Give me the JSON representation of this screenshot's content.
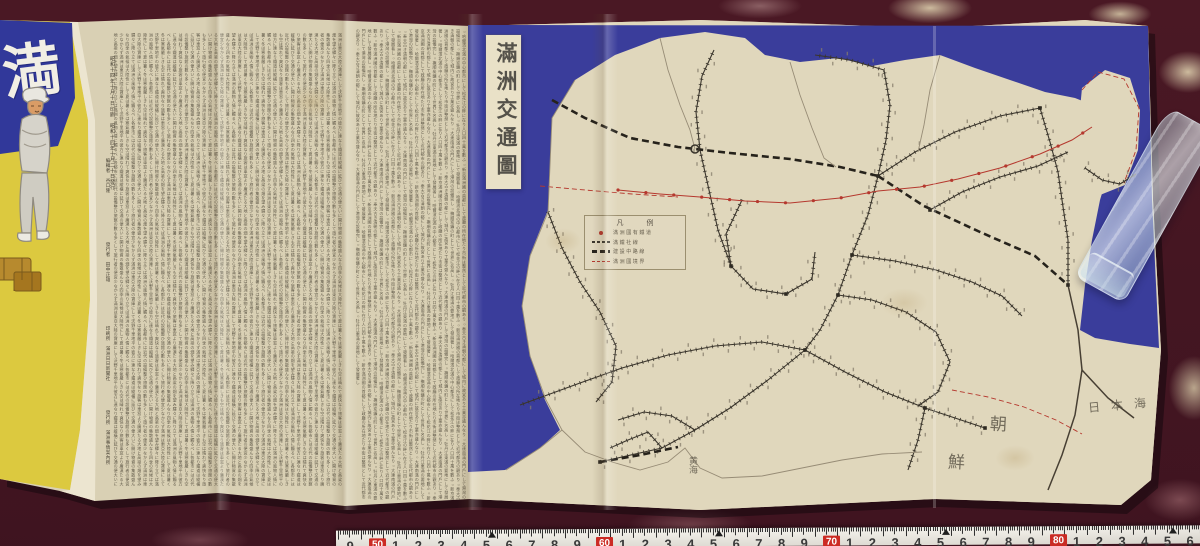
{
  "scene": {
    "carpet_color": "#46172270",
    "paper_color": "#d9d0b4",
    "map_paper_color": "#e0d7bc",
    "sea_color": "#3a3d9b",
    "cover_yellow": "#dcc93f",
    "cover_blue": "#31389a",
    "ink_color": "#4f483a",
    "red_line_color": "#b5382e",
    "rail_color": "#3a352c"
  },
  "cover": {
    "character": "満"
  },
  "colophon": {
    "date_lines": [
      "昭和十四年十月十日印刷",
      "昭和十四年十月二十日發行"
    ],
    "roles": [
      "編輯者　谷口隆",
      "發行者　田中正雄",
      "印刷所　滿洲日日新聞社",
      "發行所　滿洲事情案內所"
    ]
  },
  "text_blocks": {
    "block_a_filler": "滿洲は東亞大陸の寶庫にして沃野千里地平の彼方に連なり鐵道は縱橫に延びて交通の便大いに開け物資の集散盛んなり四季の氣候は大陸性にして夏は暑く冬は寒氣嚴しきも空は晴れて爽快なり旅客は車窓より廣漠たる大地と高粱の畑を望み驛々に降り立てば滿洲の風物人情に觸るべし各都市には近代の設備整ひ旅館の數も多くして旅行者の便宜少なからず",
    "block_b_filler": "○哈爾濱北滿の中心都市にして松花江の畔に在り人口四十萬を數ふ○新京滿洲國の首都にして政廳の所在地たり市街は整然として近代都市の觀あり○奉天古き清朝の都にして城内に故宮あり工業亦盛んなり○大連南滿の門戶にして港灣の設備完し○撫順炭鑛の町として世界に名高し○牡丹江東滿の要地にして發展著し"
  },
  "map": {
    "title": "滿洲交通圖",
    "legend": {
      "title": "凡　例",
      "rows": [
        {
          "sym": "dot",
          "label": "滿洲國有鐵道"
        },
        {
          "sym": "rail",
          "label": "滿鐵社線"
        },
        {
          "sym": "thick",
          "label": "建設中路線"
        },
        {
          "sym": "reddash",
          "label": "滿洲國境界"
        }
      ]
    },
    "sea_labels": [
      {
        "text": "朝",
        "x": 990,
        "y": 410,
        "size": 17,
        "rot": 3
      },
      {
        "text": "鮮",
        "x": 948,
        "y": 448,
        "size": 17,
        "rot": 3
      },
      {
        "text": "日本海",
        "x": 1088,
        "y": 396,
        "size": 12,
        "ls": 11,
        "rot": -5
      },
      {
        "text": "黄海",
        "x": 686,
        "y": 456,
        "size": 9,
        "vertical": true
      }
    ],
    "railways": {
      "ladder": [
        [
          [
            878,
            176
          ],
          [
            886,
            140
          ],
          [
            890,
            105
          ],
          [
            884,
            70
          ]
        ],
        [
          [
            878,
            176
          ],
          [
            915,
            152
          ],
          [
            955,
            132
          ],
          [
            1000,
            116
          ],
          [
            1040,
            108
          ]
        ],
        [
          [
            878,
            176
          ],
          [
            868,
            215
          ],
          [
            852,
            255
          ],
          [
            838,
            295
          ],
          [
            820,
            330
          ],
          [
            805,
            350
          ]
        ],
        [
          [
            805,
            350
          ],
          [
            768,
            380
          ],
          [
            730,
            408
          ],
          [
            695,
            430
          ],
          [
            662,
            448
          ],
          [
            600,
            462
          ]
        ],
        [
          [
            805,
            350
          ],
          [
            845,
            372
          ],
          [
            885,
            392
          ],
          [
            925,
            408
          ],
          [
            985,
            428
          ]
        ],
        [
          [
            805,
            350
          ],
          [
            762,
            342
          ],
          [
            715,
            346
          ],
          [
            668,
            355
          ],
          [
            622,
            368
          ],
          [
            580,
            383
          ],
          [
            520,
            405
          ]
        ],
        [
          [
            1040,
            108
          ],
          [
            1050,
            142
          ],
          [
            1058,
            172
          ],
          [
            1062,
            200
          ],
          [
            1068,
            240
          ],
          [
            1068,
            285
          ]
        ],
        [
          [
            930,
            210
          ],
          [
            962,
            192
          ],
          [
            1000,
            177
          ],
          [
            1038,
            166
          ],
          [
            1068,
            152
          ]
        ],
        [
          [
            838,
            295
          ],
          [
            872,
            300
          ],
          [
            906,
            312
          ],
          [
            936,
            332
          ],
          [
            950,
            362
          ],
          [
            938,
            392
          ],
          [
            918,
            406
          ]
        ],
        [
          [
            852,
            255
          ],
          [
            895,
            261
          ],
          [
            936,
            270
          ],
          [
            972,
            282
          ],
          [
            1002,
            296
          ],
          [
            1022,
            316
          ]
        ],
        [
          [
            742,
            200
          ],
          [
            726,
            234
          ],
          [
            731,
            266
          ],
          [
            753,
            289
          ],
          [
            786,
            294
          ],
          [
            812,
            279
          ],
          [
            815,
            252
          ]
        ],
        [
          [
            700,
            150
          ],
          [
            709,
            190
          ],
          [
            718,
            230
          ],
          [
            731,
            266
          ]
        ],
        [
          [
            700,
            150
          ],
          [
            696,
            112
          ],
          [
            702,
            76
          ],
          [
            714,
            50
          ]
        ],
        [
          [
            884,
            70
          ],
          [
            850,
            60
          ],
          [
            815,
            55
          ]
        ],
        [
          [
            548,
            212
          ],
          [
            562,
            248
          ],
          [
            580,
            282
          ],
          [
            600,
            312
          ],
          [
            616,
            346
          ],
          [
            612,
            382
          ],
          [
            596,
            402
          ]
        ],
        [
          [
            695,
            430
          ],
          [
            672,
            416
          ],
          [
            644,
            412
          ],
          [
            618,
            420
          ]
        ],
        [
          [
            662,
            448
          ],
          [
            648,
            432
          ],
          [
            628,
            440
          ],
          [
            610,
            448
          ]
        ],
        [
          [
            1085,
            168
          ],
          [
            1102,
            180
          ],
          [
            1120,
            184
          ],
          [
            1136,
            174
          ]
        ],
        [
          [
            925,
            408
          ],
          [
            918,
            440
          ],
          [
            908,
            470
          ]
        ]
      ],
      "thick": [
        [
          [
            552,
            100
          ],
          [
            585,
            118
          ],
          [
            630,
            138
          ],
          [
            678,
            147
          ],
          [
            730,
            153
          ],
          [
            790,
            159
          ],
          [
            840,
            167
          ],
          [
            878,
            176
          ]
        ],
        [
          [
            878,
            176
          ],
          [
            924,
            206
          ],
          [
            980,
            232
          ],
          [
            1035,
            256
          ],
          [
            1068,
            285
          ]
        ],
        [
          [
            600,
            462
          ],
          [
            640,
            455
          ],
          [
            678,
            447
          ]
        ]
      ],
      "red": [
        [
          [
            618,
            190
          ],
          [
            660,
            194
          ],
          [
            700,
            197
          ],
          [
            745,
            201
          ],
          [
            790,
            203
          ],
          [
            840,
            198
          ],
          [
            878,
            191
          ],
          [
            920,
            187
          ],
          [
            958,
            179
          ],
          [
            1000,
            168
          ],
          [
            1040,
            154
          ],
          [
            1072,
            140
          ],
          [
            1092,
            127
          ]
        ]
      ],
      "red_dash": [
        [
          [
            540,
            186
          ],
          [
            585,
            190
          ],
          [
            632,
            194
          ],
          [
            678,
            197
          ]
        ],
        [
          [
            1082,
            90
          ],
          [
            1098,
            72
          ],
          [
            1124,
            79
          ],
          [
            1139,
            108
          ],
          [
            1136,
            150
          ],
          [
            1124,
            183
          ]
        ],
        [
          [
            952,
            390
          ],
          [
            988,
            397
          ],
          [
            1024,
            407
          ],
          [
            1056,
            420
          ],
          [
            1082,
            434
          ]
        ]
      ],
      "coast": [
        [
          [
            575,
            80
          ],
          [
            552,
            118
          ],
          [
            548,
            212
          ],
          [
            530,
            256
          ],
          [
            522,
            306
          ],
          [
            530,
            356
          ],
          [
            546,
            400
          ],
          [
            562,
            430
          ],
          [
            540,
            448
          ],
          [
            506,
            470
          ]
        ],
        [
          [
            562,
            430
          ],
          [
            585,
            452
          ],
          [
            612,
            462
          ],
          [
            640,
            470
          ],
          [
            668,
            462
          ],
          [
            685,
            448
          ],
          [
            700,
            468
          ],
          [
            722,
            478
          ],
          [
            762,
            476
          ],
          [
            802,
            468
          ],
          [
            842,
            460
          ],
          [
            882,
            454
          ],
          [
            922,
            452
          ]
        ],
        [
          [
            790,
            62
          ],
          [
            800,
            95
          ],
          [
            812,
            128
          ],
          [
            824,
            158
          ],
          [
            836,
            167
          ]
        ],
        [
          [
            940,
            55
          ],
          [
            930,
            90
          ],
          [
            924,
            125
          ],
          [
            918,
            152
          ]
        ],
        [
          [
            660,
            38
          ],
          [
            668,
            70
          ],
          [
            680,
            105
          ],
          [
            690,
            130
          ],
          [
            695,
            149
          ]
        ]
      ],
      "plain": [
        [
          [
            1068,
            285
          ],
          [
            1078,
            330
          ],
          [
            1082,
            370
          ],
          [
            1075,
            415
          ],
          [
            1062,
            455
          ],
          [
            1048,
            490
          ]
        ],
        [
          [
            1082,
            370
          ],
          [
            1108,
            398
          ],
          [
            1134,
            418
          ]
        ]
      ]
    },
    "stations": [
      [
        878,
        176
      ],
      [
        805,
        350
      ],
      [
        838,
        295
      ],
      [
        930,
        210
      ],
      [
        1040,
        108
      ],
      [
        731,
        266
      ],
      [
        600,
        462
      ],
      [
        985,
        428
      ],
      [
        1068,
        285
      ],
      [
        852,
        255
      ],
      [
        925,
        408
      ],
      [
        786,
        294
      ]
    ],
    "circle_station": [
      695,
      149
    ]
  },
  "ruler": {
    "decades": [
      [
        "40",
        142
      ],
      [
        "50",
        369
      ],
      [
        "60",
        596
      ],
      [
        "70",
        823
      ],
      [
        "80",
        1050
      ]
    ],
    "unit_step": 22.7,
    "origin_x": 336,
    "width": 864
  }
}
